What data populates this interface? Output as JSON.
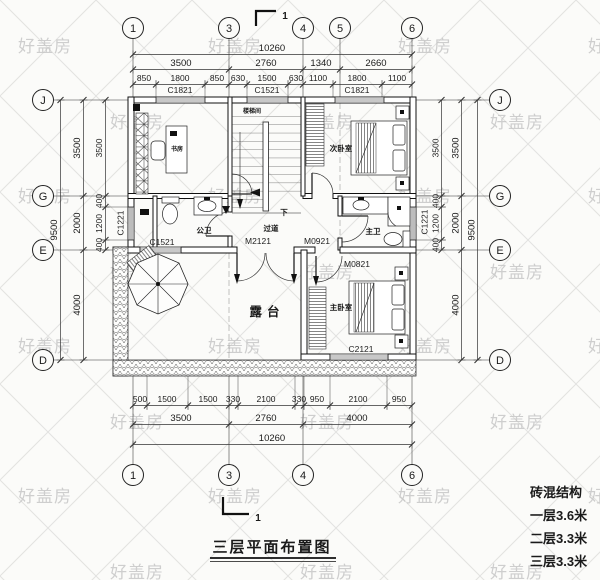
{
  "title": "三层平面布置图",
  "section_label": "1",
  "watermark": "好盖房",
  "notes": {
    "l1": "砖混结构",
    "l2": "一层3.6米",
    "l3": "二层3.3米",
    "l4": "三层3.3米"
  },
  "grid": {
    "top": [
      "1",
      "3",
      "4",
      "5",
      "6"
    ],
    "bottom": [
      "1",
      "3",
      "4",
      "6"
    ],
    "left": [
      "J",
      "G",
      "E",
      "D"
    ],
    "right": [
      "J",
      "G",
      "E",
      "D"
    ]
  },
  "rooms": {
    "study": "书房",
    "stair": "楼梯间",
    "down": "下",
    "bed2": "次卧室",
    "bath2": "公卫",
    "hall": "过道",
    "bath1": "主卫",
    "bed1": "主卧室",
    "terrace": "露台"
  },
  "openings": {
    "c1821": "C1821",
    "c1521": "C1521",
    "c1221": "C1221",
    "c2121": "C2121",
    "m2121": "M2121",
    "m0921": "M0921",
    "m0821": "M0821"
  },
  "dims": {
    "top_total": "10260",
    "top_major": [
      "3500",
      "2760",
      "1340",
      "2660"
    ],
    "top_minor": [
      "850",
      "1800",
      "850",
      "630",
      "1500",
      "630",
      "1100",
      "1800",
      "1100"
    ],
    "bottom_total": "10260",
    "bottom_major": [
      "3500",
      "2760",
      "4000"
    ],
    "bottom_minor": [
      "500",
      "1500",
      "1500",
      "330",
      "2100",
      "330",
      "950",
      "2100",
      "950"
    ],
    "left_total": "9500",
    "left_major": [
      "3500",
      "2000",
      "4000"
    ],
    "left_minor": [
      "3500",
      "400",
      "1200",
      "400"
    ],
    "right_total": "9500",
    "right_major": [
      "3500",
      "2000",
      "4000"
    ],
    "right_minor": [
      "3500",
      "400",
      "1200",
      "400"
    ]
  }
}
